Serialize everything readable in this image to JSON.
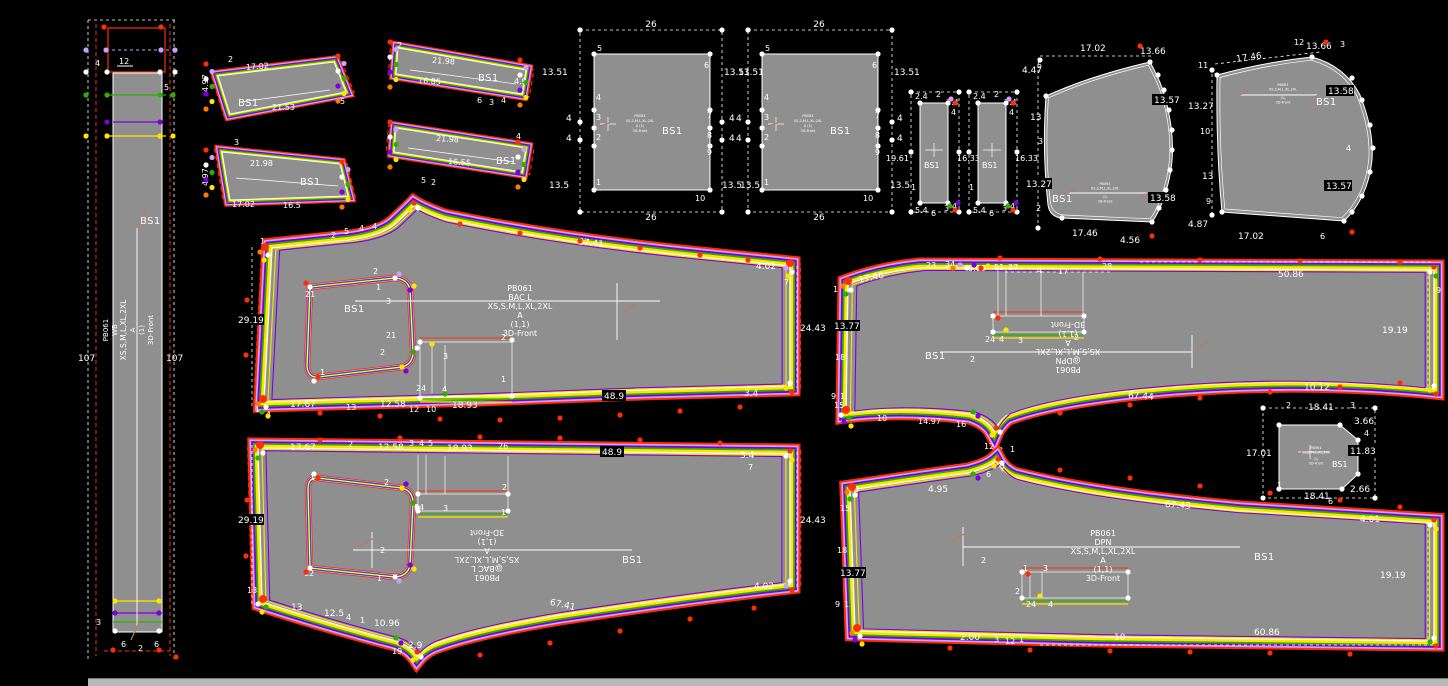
{
  "window": {
    "background": "#000000"
  },
  "palette": {
    "red": "#ff2e00",
    "violet": "#c9a0ff",
    "purple": "#7a00dc",
    "green": "#2fae00",
    "yellow": "#ffe400",
    "white": "#ffffff",
    "piece_gray": "#8f8f8f",
    "scrollbar": "#b9b9b9"
  },
  "pieces": {
    "wb": {
      "d4": "4",
      "d12": "12",
      "p5": "5",
      "left107": "107",
      "right107": "107",
      "code": "PB061",
      "name": "WB",
      "sizes": "XS,S,M,L,XL,2XL",
      "grade": "A",
      "qty": "(1)",
      "view": "3D-Front",
      "bs": "BS1",
      "p3": "3",
      "b6a": "6",
      "b2": "2",
      "b6b": "6"
    },
    "b1": {
      "dtop": "17.02",
      "dleft": "4.97",
      "bs": "BS1",
      "len": "21.53",
      "p5": "5",
      "p2": "2"
    },
    "b2": {
      "p3": "3",
      "len": "21.98",
      "bs": "BS1",
      "dleft": "4.97",
      "db1": "17.02",
      "db2": "16.5"
    },
    "b3": {
      "p2": "2",
      "len": "21.98",
      "mid": "16.85",
      "bs": "BS1",
      "dright": "4.9",
      "pb1": "6",
      "pb2": "3",
      "pb3": "4"
    },
    "b4": {
      "len": "21.98",
      "mid": "16.55",
      "bs": "BS1",
      "pr": "4",
      "pb1": "5",
      "pb2": "2"
    },
    "pk1": {
      "dtop": "26",
      "dbot": "26",
      "dl1": "13.51",
      "dl2": "4",
      "dl3": "4",
      "dl4": "13.5",
      "dr1": "13.51",
      "dr2": "4",
      "dr3": "4",
      "dr4": "13.5",
      "p1": "1",
      "p2": "2",
      "p3": "3",
      "p4": "4",
      "p5": "5",
      "p6": "6",
      "p7": "7",
      "p8": "8",
      "p9": "9",
      "p10": "10",
      "bs": "BS1",
      "t1": "PB061",
      "t2": "XS,S,M,L,XL,2XL",
      "t3": "A (1)",
      "t4": "3D-Front"
    },
    "pk2": {
      "dtop": "26",
      "dbot": "26",
      "dl1": "13.51",
      "dl2": "4",
      "dl3": "4",
      "dl4": "13.5",
      "dr1": "13.51",
      "dr2": "4",
      "dr3": "4",
      "dr4": "13.5",
      "p1": "1",
      "p2": "2",
      "p3": "3",
      "p4": "4",
      "p5": "5",
      "p6": "6",
      "p7": "7",
      "p8": "8",
      "p9": "9",
      "p10": "10",
      "bs": "BS1",
      "t1": "PB061",
      "t2": "XS,S,M,L,XL,2XL",
      "t3": "A (1)",
      "t4": "3D-Front"
    },
    "s1": {
      "dt1": "2.4",
      "pt": "2",
      "dt2": "2.4",
      "pt2": "4",
      "dleft": "19.61",
      "dright": "16.33",
      "pb0": "1",
      "db": "5.4",
      "pb1": "6",
      "pb2": "3",
      "pb3": "4",
      "bs": "BS1"
    },
    "s2": {
      "dt1": "2.4",
      "pt": "2",
      "dt2": "2.4",
      "pt2": "4",
      "dright": "16.33",
      "pb0": "1",
      "db": "5.4",
      "pb1": "6",
      "pb2": "3",
      "pb3": "4",
      "bs": "BS1"
    },
    "sl": {
      "ptl": "5",
      "dtop": "17.02",
      "dtr": "13.66",
      "dl1": "4.47",
      "dl2": "13",
      "pl": "3",
      "dl3": "13.27",
      "pbl": "2",
      "dr1": "13.57",
      "dr2": "13.58",
      "db": "17.46",
      "dbr": "4.56",
      "bs": "BS1",
      "t1": "PB061",
      "t2": "XS,S,M,L,XL,2XL",
      "t3": "(1)",
      "t4": "3D-Front"
    },
    "sr": {
      "ptl": "11",
      "dtop": "17.46",
      "pt": "12",
      "dtr": "13.66",
      "pt2": "3",
      "dr1": "13.58",
      "pr": "4",
      "dr2": "13.57",
      "dl1": "13.27",
      "pl1": "10",
      "dl2": "13",
      "pl2": "9",
      "dbl": "4.87",
      "db": "17.02",
      "pb": "6",
      "bs": "BS1",
      "t1": "PB061",
      "t2": "XS,S,M,L,XL,2XL",
      "t3": "(1)",
      "t4": "3D-Front"
    },
    "bt": {
      "dleft": "29.19",
      "pa": "1",
      "pb": "2",
      "pc": "5",
      "pd": "4",
      "pe": "4",
      "dtop": "67.41",
      "dtr": "4.02",
      "p7": "7",
      "dright": "24.43",
      "db1": "17.67",
      "p13": "13",
      "db2": "12.58",
      "p12": "12",
      "p10": "10",
      "db3": "18.93",
      "db4": "48.9",
      "db5": "3.4",
      "p1": "1",
      "p4": "4",
      "k2": "2",
      "k1": "1",
      "k21": "21",
      "k3": "3",
      "k21b": "21",
      "k2b": "2",
      "k1b": "1",
      "r2": "2",
      "r3": "3",
      "r1": "1",
      "r24": "24",
      "r4": "4",
      "code": "PB061",
      "name": "BAC L",
      "sizes": "XS,S,M,L,XL,2XL",
      "grade": "A",
      "qty": "(1,1)",
      "view": "3D-Front",
      "bs": "BS1"
    },
    "ft": {
      "dtl": "17.46",
      "p1": "1",
      "p23": "23",
      "p34": "34",
      "d0": "0.00",
      "p51": "51",
      "p37": "37",
      "p4": "4",
      "p17": "17",
      "p28": "28",
      "dtop": "50.86",
      "p9": "9",
      "dright": "19.19",
      "dleft": "13.77",
      "p18": "18",
      "p9b": "9",
      "p1b": "1",
      "p15": "15",
      "dbl1": "10",
      "dbl2": "14.97",
      "dbl3": "16",
      "p12": "12",
      "p3": "3",
      "p1c": "1",
      "dbot": "67.44",
      "dbr": "10.12",
      "r24": "24",
      "r4": "4",
      "r3": "3",
      "r2": "2",
      "p2": "2",
      "bs": "BS1",
      "code": "PB061",
      "name": "@DPN",
      "sizes": "XS,S,M,L,XL,2XL",
      "grade": "A",
      "qty": "(1,1)",
      "view": "3D-Front"
    },
    "bb": {
      "dt1": "17.67",
      "p2": "2",
      "dt2": "12.58",
      "p3": "3",
      "p4": "4",
      "p5": "5",
      "dt3": "18.93",
      "p26": "26",
      "dt4": "48.9",
      "dt5": "3.4",
      "p7": "7",
      "dleft": "29.19",
      "p13": "13",
      "dright": "24.43",
      "dbr": "4.02",
      "db1": "13",
      "db2": "12.5",
      "p4b": "4",
      "p1": "1",
      "db3": "10.96",
      "p19": "19",
      "db4": "2.9",
      "db5": "67.41",
      "k1": "1",
      "k2": "2",
      "k12": "12",
      "k2b": "2",
      "k1b": "1",
      "r24": "24",
      "r3": "3",
      "r2": "2",
      "r1": "1",
      "code": "PB061",
      "name": "@BAC L",
      "sizes": "XS,S,M,L,XL,2XL",
      "grade": "A",
      "qty": "(1,1)",
      "view": "3D-Front",
      "bs": "BS1"
    },
    "fb": {
      "p3": "3",
      "dt1": "4.95",
      "p6": "6",
      "p7": "7",
      "dtop": "67.43",
      "dtr": "4.01",
      "dright": "19.19",
      "dleft": "13.77",
      "p15": "15",
      "p18": "18",
      "p9": "9",
      "p1": "1",
      "db1": "2.00",
      "p3b": "3",
      "p12": "12",
      "p1b": "1",
      "db2": "10",
      "db3": "60.86",
      "r1": "1",
      "r3": "3",
      "r2": "2",
      "r24": "24",
      "r4": "4",
      "p2": "2",
      "code": "PB061",
      "name": "DPN",
      "sizes": "XS,S,M,L,XL,2XL",
      "grade": "A",
      "qty": "(1,1)",
      "view": "3D-Front",
      "bs": "BS1"
    },
    "sq": {
      "p2": "2",
      "dtop": "18.41",
      "p3": "3",
      "dr1": "3.66",
      "p4": "4",
      "dr2": "11.83",
      "dr3": "2.66",
      "p1": "1",
      "dbot": "18.41",
      "p6": "6",
      "dleft": "17.01",
      "bs": "BS1",
      "t1": "PB061",
      "t2": "XS,S,M,L,XL,2XL",
      "t3": "(1)",
      "t4": "3D-Front"
    }
  }
}
